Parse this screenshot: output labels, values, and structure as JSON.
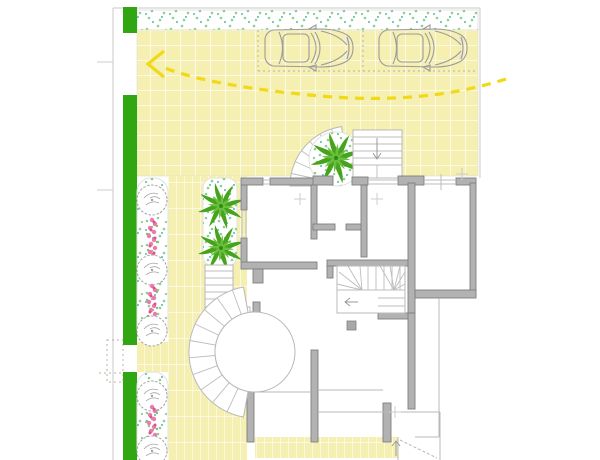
{
  "canvas": {
    "width": 600,
    "height": 460
  },
  "colors": {
    "background": "#ffffff",
    "pavement": "#f5efb2",
    "pavement_line": "#ffffff",
    "hedge": "#2fa612",
    "palm": "#46a31c",
    "palm_light": "#6abf3e",
    "palm_dark": "#2e8c10",
    "speckle_green": "#8ccf8f",
    "speckle_teal": "#52b9a3",
    "flower_pink": "#ee79ab",
    "flower_deep": "#d95590",
    "flower_leaf": "#7cc46a",
    "wall_fill": "#b2b2b2",
    "wall_stroke": "#7f7f7f",
    "thin_line": "#b9b9b9",
    "boundary": "#c9c9c9",
    "parking_dash": "#b3b3a4",
    "arrow_yellow": "#f0d916",
    "tree_stroke": "#a3a3a3",
    "car_stroke": "#9b9b9b",
    "car_shade": "#e3e3e3"
  },
  "site": {
    "drawing_type": "ground-floor site plan",
    "paved_areas": [
      "forecourt-with-square-tiles",
      "garden-path-striped-tiles",
      "rear-terrace-striped-tiles",
      "gravel-strip-top"
    ],
    "planting": {
      "hedge_segments": 3,
      "flower_borders": 2,
      "deciduous_trees": 5,
      "flower_clusters": 3,
      "palm_trees": 3,
      "palm_beds": 2
    },
    "vehicles": {
      "cars": 2,
      "view": "top",
      "parking_bays": 2,
      "bay_outline": "dashed"
    },
    "circulation": {
      "driveway_arrow": "dashed yellow curve pointing to left gate",
      "gates": [
        "driveway-gate-top-left",
        "pedestrian-gate-left"
      ]
    },
    "stairs": [
      "curved-fan-stair-entry",
      "straight-entry-stair-top",
      "interior-winder-stair",
      "round-porch-with-fan-steps",
      "porch-straight-stair",
      "rear-ramp-steps"
    ]
  }
}
